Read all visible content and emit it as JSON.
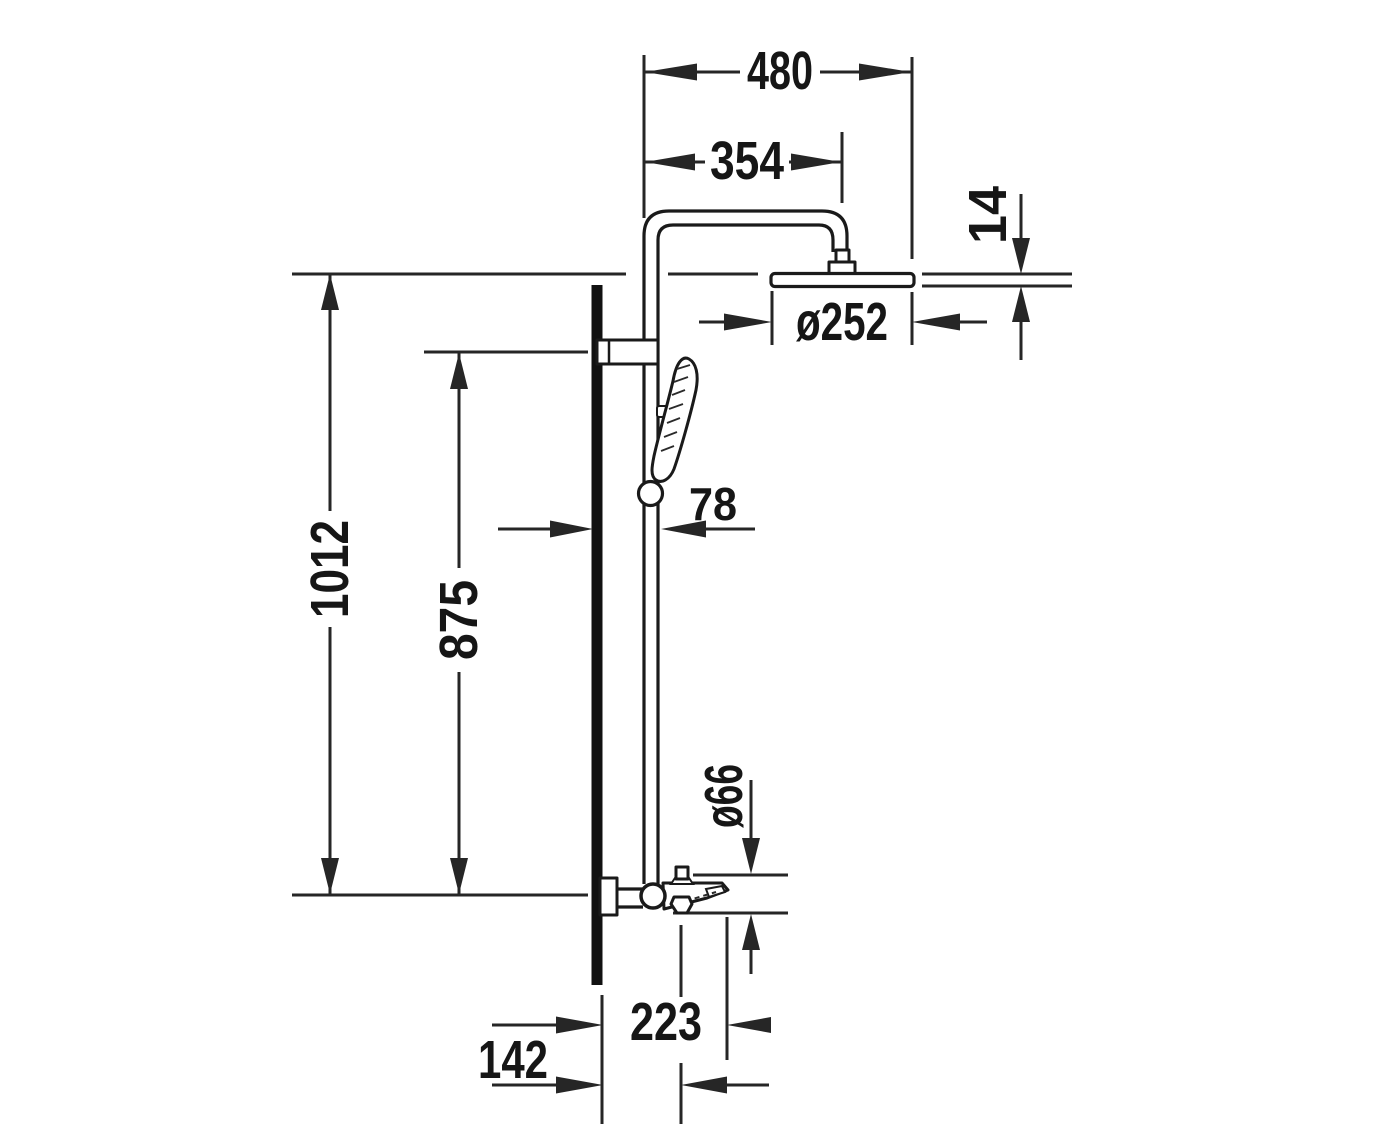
{
  "page": {
    "background_color": "#ffffff"
  },
  "drawing": {
    "line_color": "#1a1a1a",
    "dimension_color": "#262626",
    "labels": {
      "arm_width": "480",
      "arm_projection": "354",
      "head_thickness": "14",
      "head_diameter": "ø252",
      "rail_wall_offset": "78",
      "overall_height": "1012",
      "rail_height": "875",
      "mixer_body_diameter": "ø66",
      "spout_reach": "223",
      "spout_outlet_offset": "142"
    }
  }
}
